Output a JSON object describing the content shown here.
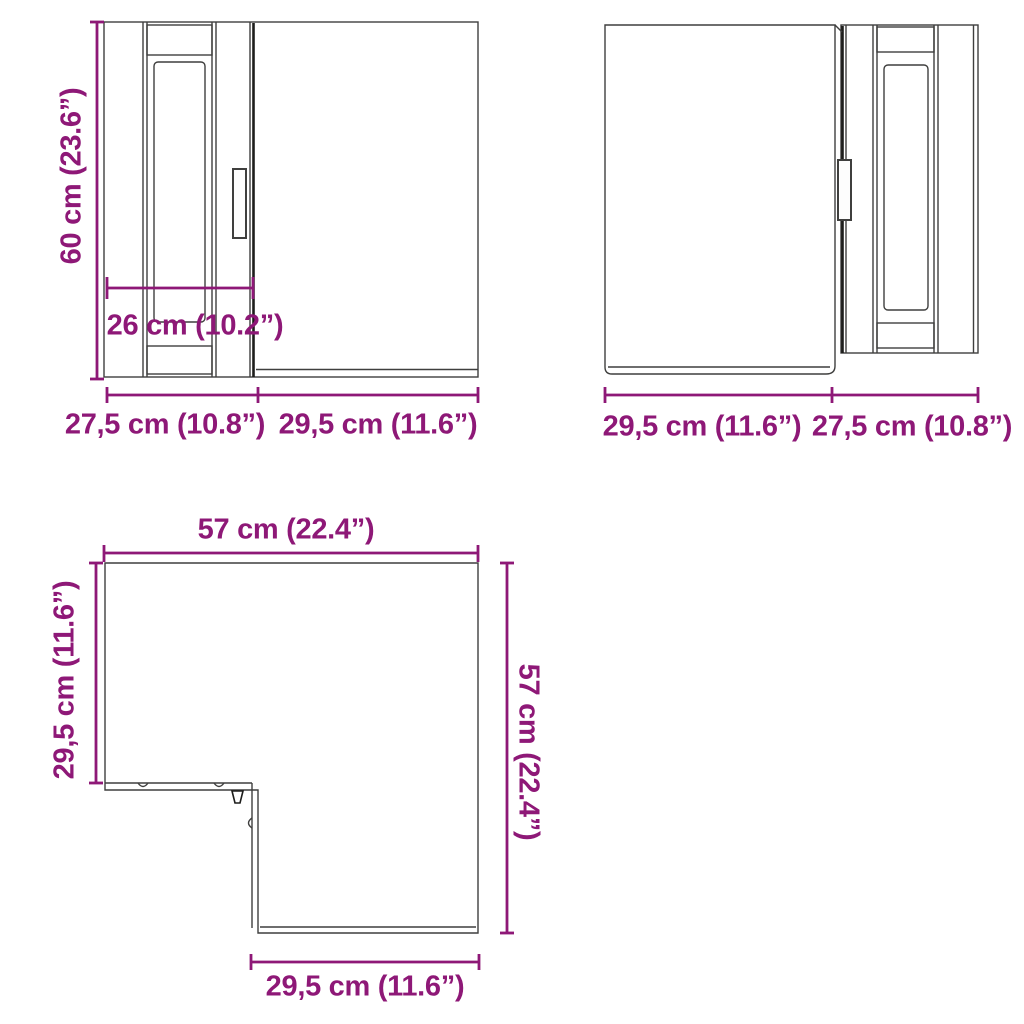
{
  "colors": {
    "dimension_text": "#8E1877",
    "outline": "#3F3F3E",
    "outline_dark": "#1D1D1B",
    "background": "#FFFFFF"
  },
  "views": {
    "front_left": {
      "height": "60 cm (23.6”)",
      "door_width": "26 cm (10.2”)",
      "bottom_left_width": "27,5 cm (10.8”)",
      "bottom_right_width": "29,5 cm (11.6”)"
    },
    "front_right": {
      "bottom_left_width": "29,5 cm (11.6”)",
      "bottom_right_width": "27,5 cm (10.8”)"
    },
    "top": {
      "width_top": "57 cm (22.4”)",
      "depth_left": "29,5 cm (11.6”)",
      "height_right": "57 cm (22.4”)",
      "width_bottom": "29,5 cm (11.6”)"
    }
  }
}
